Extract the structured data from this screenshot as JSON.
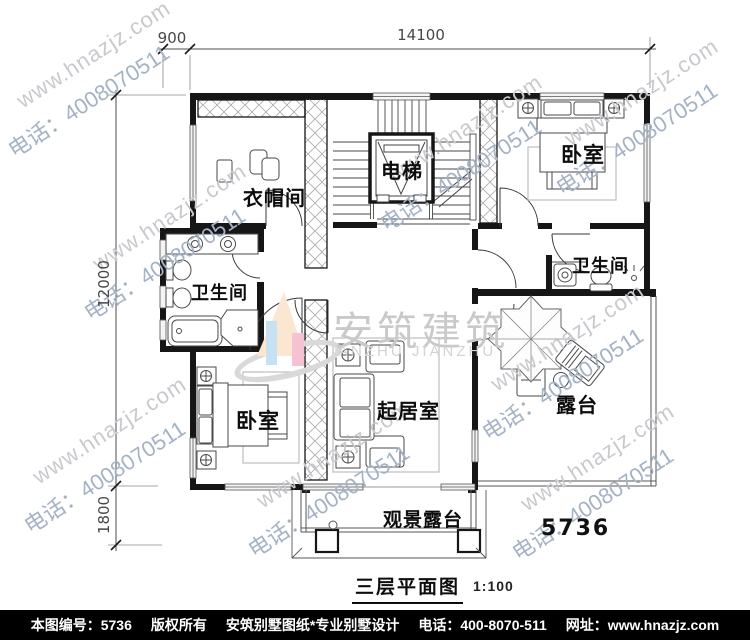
{
  "caption": {
    "title": "三层平面图",
    "scale": "1:100"
  },
  "plan_number": "5736",
  "dimensions": {
    "top_offset": "900",
    "top_width": "14100",
    "left_height": "12000",
    "left_balcony": "1800"
  },
  "rooms": {
    "cloakroom": "衣帽间",
    "elevator": "电梯",
    "bedroom_top": "卧室",
    "bathroom_left": "卫生间",
    "bathroom_right": "卫生间",
    "bedroom_bottom": "卧室",
    "living_room": "起居室",
    "terrace": "露台",
    "view_terrace": "观景露台"
  },
  "watermark": {
    "line1": "www.hnazjz.com",
    "line2": "电话：4008070511"
  },
  "logo": {
    "cn": "安筑建筑",
    "en": "ANZHU JIANZHU"
  },
  "footer": {
    "items": [
      "本图编号：5736",
      "版权所有",
      "安筑别墅图纸*专业别墅设计",
      "电话：400-8070-511",
      "网址：www.hnazjz.com"
    ]
  }
}
